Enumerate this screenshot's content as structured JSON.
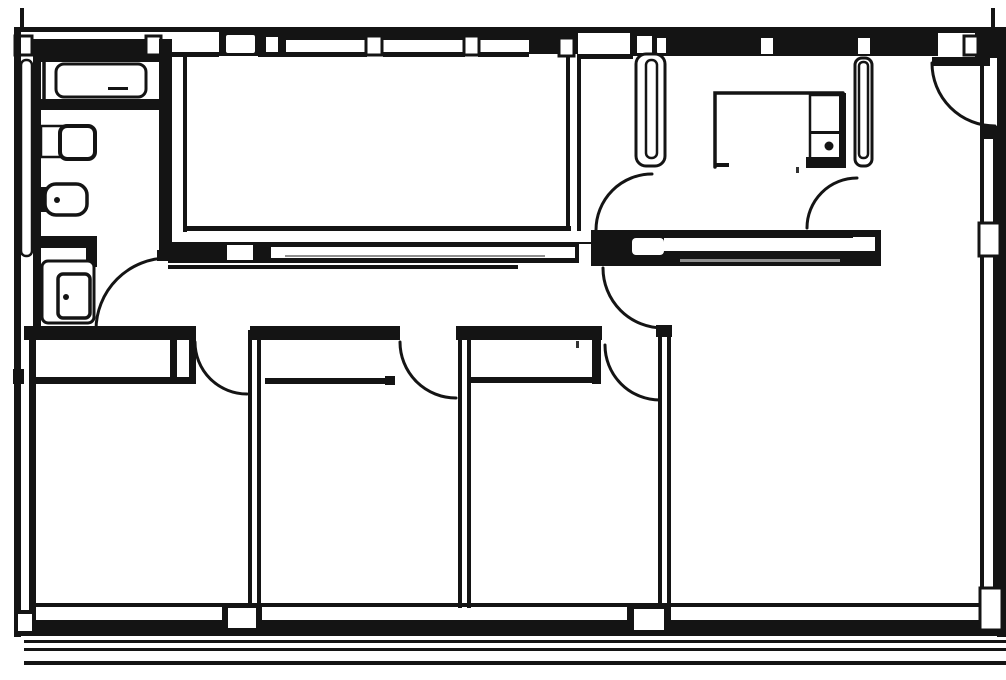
{
  "document": {
    "kind": "scanned architectural floor plan",
    "visible_text": ""
  },
  "plan": {
    "canvas": {
      "width": 1006,
      "height": 680
    },
    "colors": {
      "paper": "#ffffff",
      "ink": "#141414",
      "texture": "#8f8f8f",
      "speck": "#333333"
    },
    "elements": [
      {
        "n": "top-wall-outer-left",
        "t": "rect",
        "x": 14,
        "y": 27,
        "w": 205,
        "h": 5
      },
      {
        "n": "top-wall-outer-right",
        "t": "rect",
        "x": 530,
        "y": 27,
        "w": 476,
        "h": 6
      },
      {
        "n": "top-wall-outer-thick-mid",
        "t": "rect",
        "x": 280,
        "y": 27,
        "w": 250,
        "h": 13
      },
      {
        "n": "top-wall-tick-left",
        "t": "rect",
        "x": 20,
        "y": 8,
        "w": 4,
        "h": 20
      },
      {
        "n": "top-wall-tick-right",
        "t": "rect",
        "x": 991,
        "y": 8,
        "w": 4,
        "h": 20
      },
      {
        "n": "bathroom-top-wall-band",
        "t": "rect",
        "x": 33,
        "y": 39,
        "w": 129,
        "h": 23
      },
      {
        "n": "top-opening-block",
        "t": "rect",
        "x": 219,
        "y": 27,
        "w": 45,
        "h": 29
      },
      {
        "n": "top-opening-white",
        "t": "rect",
        "x": 226,
        "y": 35,
        "w": 29,
        "h": 18,
        "rx": 2,
        "f": "paper"
      },
      {
        "n": "top-step-block",
        "t": "rect",
        "x": 258,
        "y": 27,
        "w": 28,
        "h": 30
      },
      {
        "n": "top-step-post",
        "t": "rect",
        "x": 266,
        "y": 37,
        "w": 12,
        "h": 15,
        "f": "paper"
      },
      {
        "n": "top-wall-band-mid",
        "t": "rect",
        "x": 529,
        "y": 30,
        "w": 49,
        "h": 24
      },
      {
        "n": "radiator-junction-block",
        "t": "rect",
        "x": 630,
        "y": 30,
        "w": 40,
        "h": 26
      },
      {
        "n": "radiator-junction-notch-1",
        "t": "rect",
        "x": 637,
        "y": 36,
        "w": 15,
        "h": 17,
        "f": "paper"
      },
      {
        "n": "radiator-junction-notch-2",
        "t": "rect",
        "x": 657,
        "y": 38,
        "w": 10,
        "h": 15,
        "f": "paper"
      },
      {
        "n": "top-wall-band-right",
        "t": "rect",
        "x": 666,
        "y": 30,
        "w": 272,
        "h": 26
      },
      {
        "n": "window-notch-1",
        "t": "rect",
        "x": 761,
        "y": 38,
        "w": 12,
        "h": 16,
        "f": "paper"
      },
      {
        "n": "window-notch-2",
        "t": "rect",
        "x": 858,
        "y": 38,
        "w": 12,
        "h": 16,
        "f": "paper"
      },
      {
        "n": "top-corner-block",
        "t": "rect",
        "x": 975,
        "y": 27,
        "w": 31,
        "h": 31
      },
      {
        "n": "mullion-post-1",
        "t": "rect",
        "x": 15,
        "y": 36,
        "w": 17,
        "h": 19,
        "f": "paper",
        "s": "ink",
        "sw": 3
      },
      {
        "n": "mullion-post-2",
        "t": "rect",
        "x": 146,
        "y": 36,
        "w": 15,
        "h": 19,
        "f": "paper",
        "s": "ink",
        "sw": 3
      },
      {
        "n": "mullion-post-3",
        "t": "rect",
        "x": 366,
        "y": 36,
        "w": 16,
        "h": 19,
        "f": "paper",
        "s": "ink",
        "sw": 3
      },
      {
        "n": "mullion-post-4",
        "t": "rect",
        "x": 464,
        "y": 36,
        "w": 15,
        "h": 19,
        "f": "paper",
        "s": "ink",
        "sw": 3
      },
      {
        "n": "mullion-post-5",
        "t": "rect",
        "x": 559,
        "y": 38,
        "w": 15,
        "h": 18,
        "f": "paper",
        "s": "ink",
        "sw": 3
      },
      {
        "n": "mullion-post-6",
        "t": "rect",
        "x": 964,
        "y": 36,
        "w": 14,
        "h": 19,
        "f": "paper",
        "s": "ink",
        "sw": 3
      },
      {
        "n": "top-inner-face-1",
        "t": "rect",
        "x": 166,
        "y": 52,
        "w": 53,
        "h": 5
      },
      {
        "n": "top-inner-face-2",
        "t": "rect",
        "x": 283,
        "y": 52,
        "w": 84,
        "h": 5
      },
      {
        "n": "top-inner-face-3",
        "t": "rect",
        "x": 383,
        "y": 52,
        "w": 82,
        "h": 5
      },
      {
        "n": "top-inner-face-4",
        "t": "rect",
        "x": 478,
        "y": 52,
        "w": 51,
        "h": 5
      },
      {
        "n": "top-inner-face-5",
        "t": "rect",
        "x": 577,
        "y": 54,
        "w": 56,
        "h": 5
      },
      {
        "n": "left-wall-outer",
        "t": "rect",
        "x": 14,
        "y": 27,
        "w": 7,
        "h": 610
      },
      {
        "n": "right-wall-outer",
        "t": "rect",
        "x": 997,
        "y": 27,
        "w": 9,
        "h": 610
      },
      {
        "n": "bottom-wall-inner-line",
        "t": "rect",
        "x": 33,
        "y": 603,
        "w": 967,
        "h": 4
      },
      {
        "n": "bottom-wall-thick-band",
        "t": "rect",
        "x": 14,
        "y": 620,
        "w": 992,
        "h": 16
      },
      {
        "n": "terrace-line-1",
        "t": "rect",
        "x": 24,
        "y": 640,
        "w": 982,
        "h": 3
      },
      {
        "n": "terrace-line-2",
        "t": "rect",
        "x": 24,
        "y": 648,
        "w": 982,
        "h": 3
      },
      {
        "n": "terrace-line-3",
        "t": "rect",
        "x": 24,
        "y": 661,
        "w": 982,
        "h": 4
      },
      {
        "n": "left-wall-radiator",
        "t": "rect",
        "x": 21,
        "y": 60,
        "w": 11,
        "h": 196,
        "rx": 5,
        "f": "paper",
        "s": "ink",
        "sw": 2.5
      },
      {
        "n": "bathroom-west-wall",
        "t": "rect",
        "x": 33,
        "y": 56,
        "w": 8,
        "h": 276
      },
      {
        "n": "left-wall-inner-lower",
        "t": "rect",
        "x": 29,
        "y": 332,
        "w": 7,
        "h": 292
      },
      {
        "n": "left-wall-tick",
        "t": "rect",
        "x": 13,
        "y": 369,
        "w": 11,
        "h": 15
      },
      {
        "n": "right-wall-inner-top",
        "t": "rect",
        "x": 980,
        "y": 56,
        "w": 4,
        "h": 72
      },
      {
        "n": "right-wall-block",
        "t": "rect",
        "x": 980,
        "y": 126,
        "w": 19,
        "h": 13
      },
      {
        "n": "right-window1-line-a",
        "t": "rect",
        "x": 980,
        "y": 139,
        "w": 4,
        "h": 86
      },
      {
        "n": "right-window1-line-b",
        "t": "rect",
        "x": 993,
        "y": 139,
        "w": 4,
        "h": 86
      },
      {
        "n": "right-wall-pier",
        "t": "rect",
        "x": 979,
        "y": 223,
        "w": 21,
        "h": 33,
        "f": "paper",
        "s": "ink",
        "sw": 3
      },
      {
        "n": "right-window2-line-a",
        "t": "rect",
        "x": 980,
        "y": 256,
        "w": 4,
        "h": 334
      },
      {
        "n": "right-window2-line-b",
        "t": "rect",
        "x": 993,
        "y": 256,
        "w": 4,
        "h": 334
      },
      {
        "n": "bathroom-east-wall",
        "t": "rect",
        "x": 159,
        "y": 39,
        "w": 13,
        "h": 214
      },
      {
        "n": "bathroom-east-wall-cap",
        "t": "rect",
        "x": 157,
        "y": 250,
        "w": 17,
        "h": 11
      },
      {
        "n": "livingroom-west-face",
        "t": "rect",
        "x": 183,
        "y": 55,
        "w": 4,
        "h": 177
      },
      {
        "n": "livingroom-east-face-a",
        "t": "rect",
        "x": 566,
        "y": 55,
        "w": 4,
        "h": 176
      },
      {
        "n": "livingroom-east-face-b",
        "t": "rect",
        "x": 577,
        "y": 55,
        "w": 4,
        "h": 176
      },
      {
        "n": "livingroom-south-face",
        "t": "rect",
        "x": 185,
        "y": 226,
        "w": 386,
        "h": 5
      },
      {
        "n": "hall-north-wall-left",
        "t": "rect",
        "x": 168,
        "y": 242,
        "w": 442,
        "h": 21
      },
      {
        "n": "hall-wall-opening-1",
        "t": "rect",
        "x": 227,
        "y": 245,
        "w": 26,
        "h": 15,
        "f": "paper"
      },
      {
        "n": "hall-wall-slot-1",
        "t": "rect",
        "x": 271,
        "y": 247,
        "w": 304,
        "h": 11,
        "f": "paper"
      },
      {
        "n": "hall-wall-texture-1",
        "t": "rect",
        "x": 285,
        "y": 255,
        "w": 260,
        "h": 2,
        "f": "texture"
      },
      {
        "n": "hall-wall-gap",
        "t": "rect",
        "x": 579,
        "y": 244,
        "w": 12,
        "h": 19,
        "f": "paper"
      },
      {
        "n": "hall-north-wall-right",
        "t": "rect",
        "x": 591,
        "y": 230,
        "w": 290,
        "h": 36
      },
      {
        "n": "hall-wall-slot-2",
        "t": "rect",
        "x": 664,
        "y": 238,
        "w": 190,
        "h": 13,
        "f": "paper"
      },
      {
        "n": "hall-wall-texture-2",
        "t": "rect",
        "x": 680,
        "y": 259,
        "w": 160,
        "h": 3,
        "f": "texture"
      },
      {
        "n": "hall-wall-opening-2",
        "t": "rect",
        "x": 632,
        "y": 238,
        "w": 32,
        "h": 17,
        "rx": 4,
        "f": "paper"
      },
      {
        "n": "hall-wall-notch",
        "t": "rect",
        "x": 853,
        "y": 237,
        "w": 22,
        "h": 14,
        "f": "paper"
      },
      {
        "n": "hall-south-face-line",
        "t": "rect",
        "x": 168,
        "y": 265,
        "w": 350,
        "h": 4
      },
      {
        "n": "closet-top-band",
        "t": "rect",
        "x": 24,
        "y": 326,
        "w": 172,
        "h": 14
      },
      {
        "n": "closet-front-line",
        "t": "rect",
        "x": 36,
        "y": 377,
        "w": 160,
        "h": 7
      },
      {
        "n": "closet-end-cap-a",
        "t": "rect",
        "x": 170,
        "y": 338,
        "w": 7,
        "h": 42
      },
      {
        "n": "closet-end-cap-b",
        "t": "rect",
        "x": 189,
        "y": 338,
        "w": 7,
        "h": 42
      },
      {
        "n": "room-divider1-line-a",
        "t": "rect",
        "x": 248,
        "y": 330,
        "w": 4,
        "h": 278
      },
      {
        "n": "room-divider1-line-b",
        "t": "rect",
        "x": 257,
        "y": 330,
        "w": 4,
        "h": 278
      },
      {
        "n": "bedroom2-north-wall",
        "t": "rect",
        "x": 250,
        "y": 326,
        "w": 150,
        "h": 14
      },
      {
        "n": "room-divider2-line-a",
        "t": "rect",
        "x": 458,
        "y": 330,
        "w": 4,
        "h": 278
      },
      {
        "n": "room-divider2-line-b",
        "t": "rect",
        "x": 467,
        "y": 330,
        "w": 4,
        "h": 278
      },
      {
        "n": "bedroom3-north-wall",
        "t": "rect",
        "x": 456,
        "y": 326,
        "w": 146,
        "h": 14
      },
      {
        "n": "wardrobe2-front-line",
        "t": "rect",
        "x": 265,
        "y": 378,
        "w": 124,
        "h": 6
      },
      {
        "n": "wardrobe2-end-cap",
        "t": "rect",
        "x": 385,
        "y": 376,
        "w": 10,
        "h": 9
      },
      {
        "n": "wardrobe3-front-line",
        "t": "rect",
        "x": 468,
        "y": 377,
        "w": 126,
        "h": 6
      },
      {
        "n": "bedroom3-door-post",
        "t": "rect",
        "x": 592,
        "y": 336,
        "w": 9,
        "h": 48
      },
      {
        "n": "room-divider3-line-a",
        "t": "rect",
        "x": 658,
        "y": 327,
        "w": 4,
        "h": 279
      },
      {
        "n": "room-divider3-line-b",
        "t": "rect",
        "x": 667,
        "y": 327,
        "w": 4,
        "h": 279
      },
      {
        "n": "room-divider3-cap",
        "t": "rect",
        "x": 656,
        "y": 325,
        "w": 16,
        "h": 12
      },
      {
        "n": "bottom-pier1-outer",
        "t": "rect",
        "x": 222,
        "y": 604,
        "w": 40,
        "h": 28
      },
      {
        "n": "bottom-pier1-inner",
        "t": "rect",
        "x": 228,
        "y": 608,
        "w": 28,
        "h": 20,
        "f": "paper"
      },
      {
        "n": "bottom-pier2-outer",
        "t": "rect",
        "x": 627,
        "y": 604,
        "w": 44,
        "h": 30
      },
      {
        "n": "bottom-pier2-inner",
        "t": "rect",
        "x": 634,
        "y": 609,
        "w": 30,
        "h": 21,
        "f": "paper"
      },
      {
        "n": "left-foot-outer",
        "t": "rect",
        "x": 14,
        "y": 610,
        "w": 22,
        "h": 26
      },
      {
        "n": "left-foot-inner",
        "t": "rect",
        "x": 18,
        "y": 614,
        "w": 14,
        "h": 17,
        "f": "paper"
      },
      {
        "n": "right-foot-block",
        "t": "rect",
        "x": 980,
        "y": 588,
        "w": 22,
        "h": 42,
        "f": "paper",
        "s": "ink",
        "sw": 3
      },
      {
        "n": "hall-radiator-outer",
        "t": "rect",
        "x": 636,
        "y": 54,
        "w": 29,
        "h": 112,
        "rx": 10,
        "f": "paper",
        "s": "ink",
        "sw": 3
      },
      {
        "n": "hall-radiator-inner",
        "t": "rect",
        "x": 646,
        "y": 60,
        "w": 11,
        "h": 98,
        "rx": 5,
        "f": "paper",
        "s": "ink",
        "sw": 2.5
      },
      {
        "n": "kitchen-radiator-outer",
        "t": "rect",
        "x": 855,
        "y": 58,
        "w": 17,
        "h": 108,
        "rx": 7,
        "f": "paper",
        "s": "ink",
        "sw": 3
      },
      {
        "n": "kitchen-radiator-inner",
        "t": "rect",
        "x": 859,
        "y": 62,
        "w": 9,
        "h": 96,
        "rx": 4,
        "f": "paper",
        "s": "ink",
        "sw": 2.5
      },
      {
        "n": "kitchen-counter-edge",
        "t": "path",
        "d": "M 715 167 L 715 93 L 843 93",
        "sw": 3.5
      },
      {
        "n": "kitchen-counter-tick",
        "t": "rect",
        "x": 715,
        "y": 163,
        "w": 14,
        "h": 4
      },
      {
        "n": "kitchen-appliance-box",
        "t": "rect",
        "x": 810,
        "y": 95,
        "w": 33,
        "h": 66,
        "f": "paper",
        "s": "ink",
        "sw": 2.5
      },
      {
        "n": "kitchen-appliance-divider",
        "t": "rect",
        "x": 810,
        "y": 131,
        "w": 33,
        "h": 3
      },
      {
        "n": "kitchen-appliance-knob",
        "t": "circle",
        "cx": 829,
        "cy": 146,
        "r": 4.5
      },
      {
        "n": "kitchen-appliance-south-edge",
        "t": "rect",
        "x": 806,
        "y": 157,
        "w": 39,
        "h": 11
      },
      {
        "n": "kitchen-appliance-east-edge",
        "t": "rect",
        "x": 839,
        "y": 93,
        "w": 7,
        "h": 75
      },
      {
        "n": "bathtub-outer",
        "t": "rect",
        "x": 44,
        "y": 56,
        "w": 122,
        "h": 50,
        "f": "none",
        "s": "ink",
        "sw": 3.5
      },
      {
        "n": "bathtub-front-edge",
        "t": "rect",
        "x": 41,
        "y": 99,
        "w": 127,
        "h": 11
      },
      {
        "n": "bathtub-basin",
        "t": "rect",
        "x": 56,
        "y": 64,
        "w": 90,
        "h": 33,
        "rx": 8,
        "f": "paper",
        "s": "ink",
        "sw": 3
      },
      {
        "n": "bathtub-drain-mark",
        "t": "rect",
        "x": 108,
        "y": 87,
        "w": 20,
        "h": 3
      },
      {
        "n": "sink-counter",
        "t": "rect",
        "x": 41,
        "y": 126,
        "w": 28,
        "h": 31,
        "f": "paper",
        "s": "ink",
        "sw": 2.5
      },
      {
        "n": "sink-bowl",
        "t": "rect",
        "x": 60,
        "y": 126,
        "w": 35,
        "h": 33,
        "rx": 7,
        "f": "paper",
        "s": "ink",
        "sw": 4
      },
      {
        "n": "toilet-tank",
        "t": "rect",
        "x": 39,
        "y": 187,
        "w": 10,
        "h": 25
      },
      {
        "n": "toilet-bowl",
        "t": "rect",
        "x": 45,
        "y": 184,
        "w": 42,
        "h": 31,
        "rx": 11,
        "f": "paper",
        "s": "ink",
        "sw": 3.5
      },
      {
        "n": "toilet-drain-dot",
        "t": "circle",
        "cx": 57,
        "cy": 200,
        "r": 3
      },
      {
        "n": "bathroom-shelf-band",
        "t": "rect",
        "x": 39,
        "y": 236,
        "w": 58,
        "h": 12
      },
      {
        "n": "bathroom-corner-wall",
        "t": "rect",
        "x": 86,
        "y": 238,
        "w": 11,
        "h": 29
      },
      {
        "n": "washer-outer",
        "t": "rect",
        "x": 42,
        "y": 261,
        "w": 52,
        "h": 62,
        "rx": 6,
        "f": "paper",
        "s": "ink",
        "sw": 3
      },
      {
        "n": "washer-inner",
        "t": "rect",
        "x": 58,
        "y": 274,
        "w": 32,
        "h": 44,
        "rx": 5,
        "f": "paper",
        "s": "ink",
        "sw": 3.5
      },
      {
        "n": "washer-dot",
        "t": "circle",
        "cx": 66,
        "cy": 297,
        "r": 3
      },
      {
        "n": "bathroom-door-arc",
        "t": "path",
        "d": "M 96 330 A 72 72 0 0 1 168 258",
        "sw": 3
      },
      {
        "n": "kitchen-west-door-arc",
        "t": "path",
        "d": "M 596 230 A 56 56 0 0 1 652 174",
        "sw": 3
      },
      {
        "n": "kitchen-east-door-arc",
        "t": "path",
        "d": "M 807 228 A 50 50 0 0 1 857 178",
        "sw": 3
      },
      {
        "n": "hall-door-arc",
        "t": "path",
        "d": "M 603 268 A 60 60 0 0 0 663 328",
        "sw": 3
      },
      {
        "n": "bedroom1-door-arc",
        "t": "path",
        "d": "M 195 342 A 52 52 0 0 0 247 394",
        "sw": 3
      },
      {
        "n": "bedroom2-door-arc",
        "t": "path",
        "d": "M 400 342 A 56 56 0 0 0 456 398",
        "sw": 3
      },
      {
        "n": "bedroom3-door-arc",
        "t": "path",
        "d": "M 605 345 A 55 55 0 0 0 660 400",
        "sw": 3
      },
      {
        "n": "entry-door-leaf",
        "t": "rect",
        "x": 932,
        "y": 57,
        "w": 58,
        "h": 9
      },
      {
        "n": "entry-door-arc",
        "t": "path",
        "d": "M 932 63 A 63 63 0 0 0 995 126",
        "sw": 3
      },
      {
        "n": "scan-speck-1",
        "t": "rect",
        "x": 576,
        "y": 341,
        "w": 3,
        "h": 7,
        "f": "speck"
      },
      {
        "n": "scan-speck-2",
        "t": "rect",
        "x": 796,
        "y": 167,
        "w": 3,
        "h": 6,
        "f": "speck"
      }
    ]
  }
}
